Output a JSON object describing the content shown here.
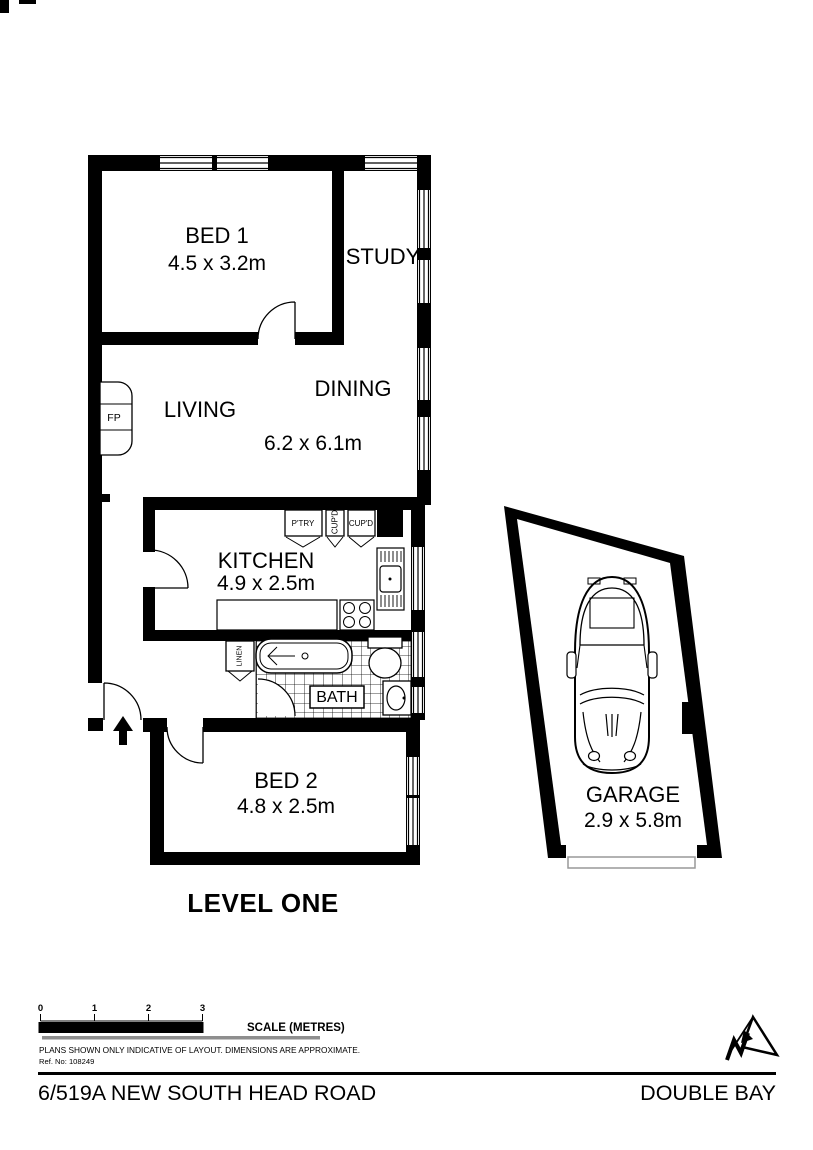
{
  "plan": {
    "level_label": "LEVEL ONE",
    "rooms": {
      "bed1": {
        "name": "BED 1",
        "dims": "4.5 x 3.2m"
      },
      "study": {
        "name": "STUDY"
      },
      "living": {
        "name": "LIVING"
      },
      "dining": {
        "name": "DINING",
        "dims": "6.2 x 6.1m"
      },
      "kitchen": {
        "name": "KITCHEN",
        "dims": "4.9 x 2.5m"
      },
      "bath": {
        "name": "BATH"
      },
      "bed2": {
        "name": "BED 2",
        "dims": "4.8 x 2.5m"
      },
      "garage": {
        "name": "GARAGE",
        "dims": "2.9 x 5.8m"
      }
    },
    "fixtures": {
      "fireplace": "FP",
      "pantry": "P'TRY",
      "cupboard1": "CUP'D",
      "cupboard2": "CUP'D",
      "linen": "LINEN"
    }
  },
  "scale_bar": {
    "ticks": [
      "0",
      "1",
      "2",
      "3"
    ],
    "label": "SCALE (METRES)"
  },
  "notes": {
    "disclaimer": "PLANS SHOWN ONLY INDICATIVE OF LAYOUT.  DIMENSIONS ARE APPROXIMATE.",
    "reference": "Ref. No: 108249"
  },
  "footer": {
    "address": "6/519A NEW SOUTH HEAD ROAD",
    "suburb": "DOUBLE BAY"
  },
  "colors": {
    "ink": "#000000",
    "paper": "#ffffff",
    "muted_line": "#8e8e8e"
  }
}
